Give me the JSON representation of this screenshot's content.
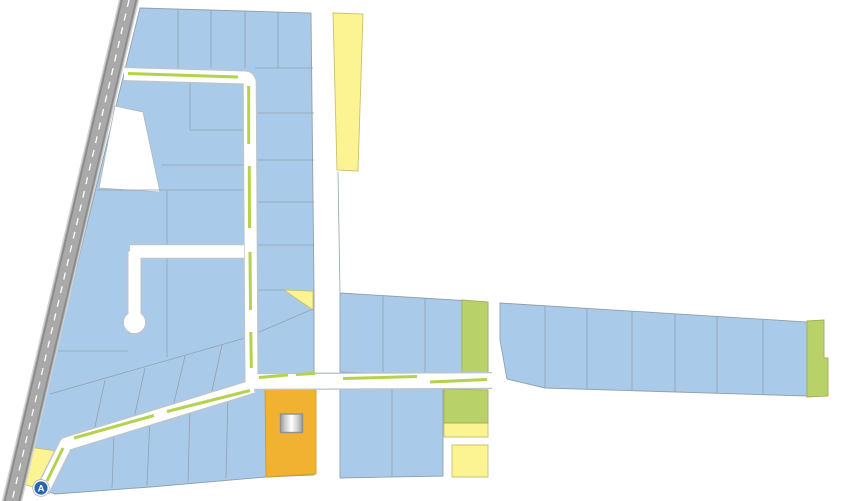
{
  "map": {
    "marker": {
      "label": "A"
    },
    "colors": {
      "parcel_blue": "#a9cbe9",
      "parcel_yellow": "#fcf493",
      "parcel_green": "#b9d169",
      "parcel_orange": "#f1b232",
      "parcel_white": "#ffffff",
      "road_white": "#ffffff",
      "road_casing_gray": "#bcc5cc",
      "road_dash_green": "#b4d24b",
      "highway_gray": "#a9a9a9",
      "highway_edge_dark": "#898989",
      "highway_edge_light": "#d2d2d2",
      "highway_dash_white": "#ffffff",
      "parcel_line_gray": "#93a1ad",
      "marker_blue": "#2a66b0",
      "marker_ring_white": "#ffffff"
    }
  }
}
